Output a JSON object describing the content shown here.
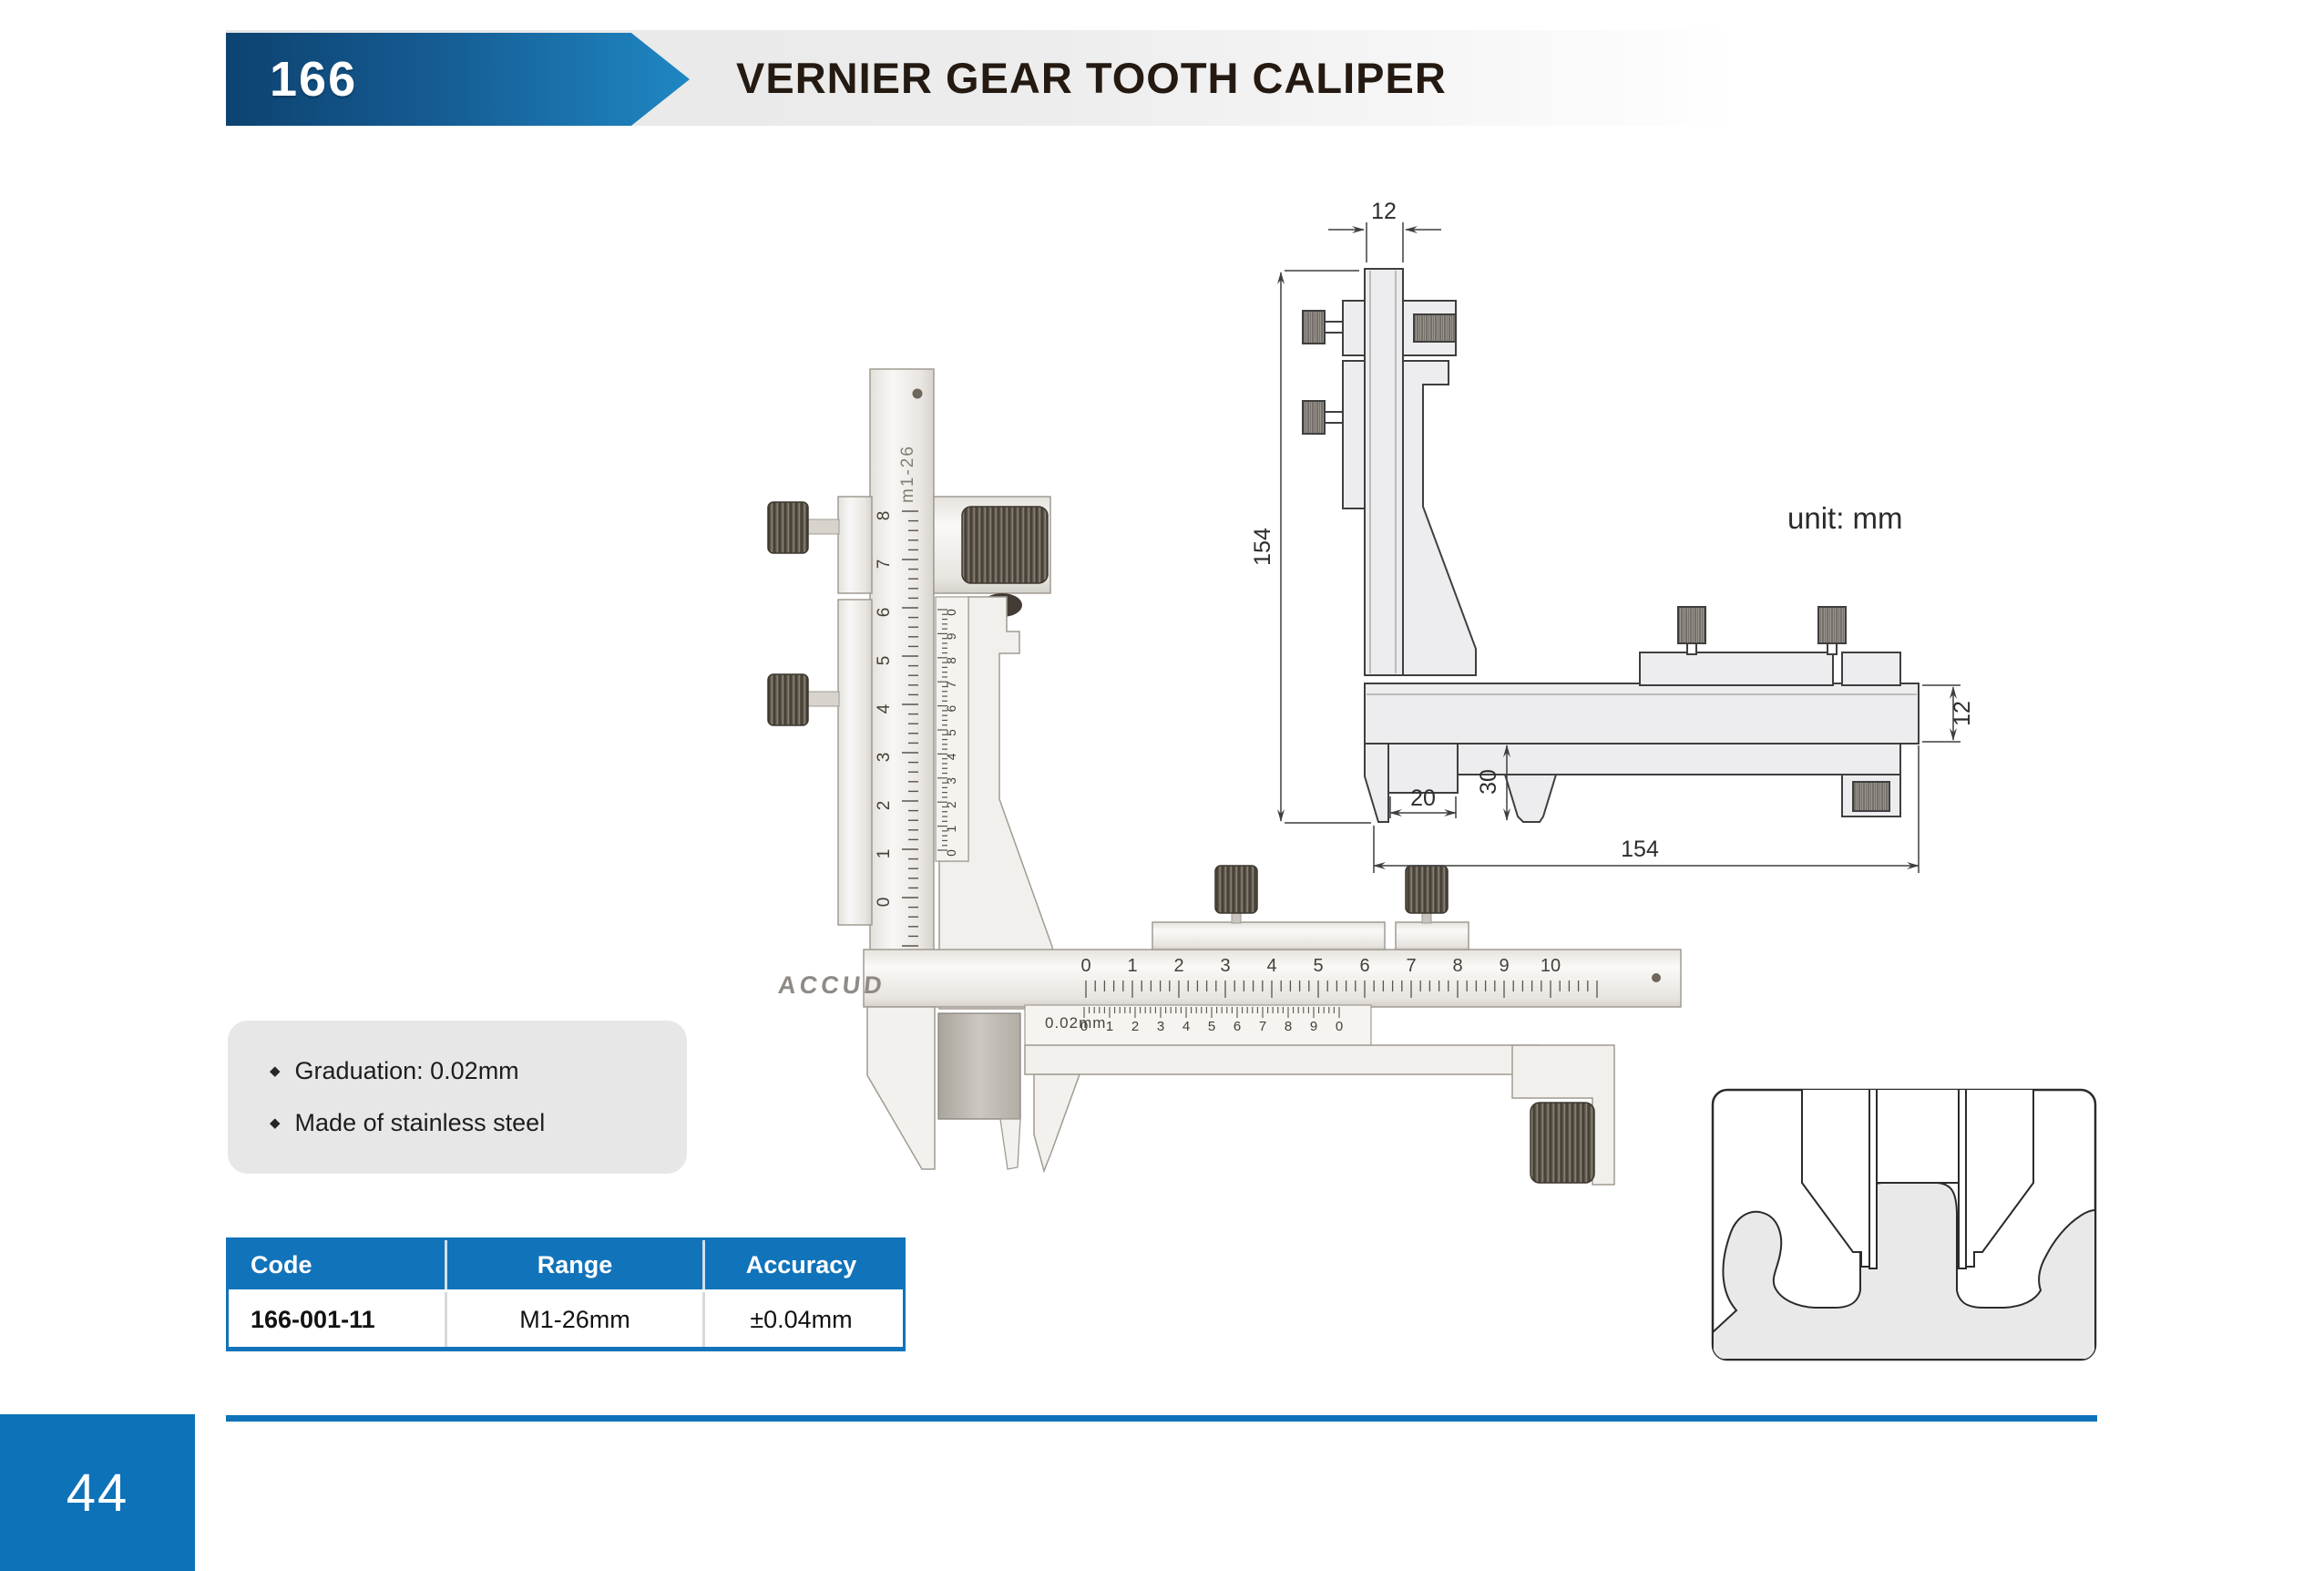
{
  "header": {
    "code": "166",
    "title": "VERNIER GEAR TOOTH CALIPER"
  },
  "drawing": {
    "unit_label": "unit: mm",
    "dimensions": {
      "top_width": "12",
      "total_height": "154",
      "beam_section": "12",
      "total_length": "154",
      "jaw_step_width": "20",
      "jaw_depth": "30"
    }
  },
  "caliper": {
    "brand": "ACCUD",
    "module_range_label": "m1-26",
    "vernier_resolution_label": "0.02mm",
    "vertical_main_numbers": [
      "8",
      "7",
      "6",
      "5",
      "4",
      "3",
      "2",
      "1",
      "0"
    ],
    "vertical_vernier_numbers": [
      "0",
      "9",
      "8",
      "7",
      "6",
      "5",
      "4",
      "3",
      "2",
      "1",
      "0"
    ],
    "horizontal_main_numbers": [
      "0",
      "1",
      "2",
      "3",
      "4",
      "5",
      "6",
      "7",
      "8",
      "9",
      "10"
    ],
    "horizontal_vernier_numbers": [
      "0",
      "1",
      "2",
      "3",
      "4",
      "5",
      "6",
      "7",
      "8",
      "9",
      "0"
    ]
  },
  "features": {
    "bullet": "◆",
    "items": [
      "Graduation: 0.02mm",
      "Made of stainless steel"
    ]
  },
  "table": {
    "headers": [
      "Code",
      "Range",
      "Accuracy"
    ],
    "rows": [
      {
        "code": "166-001-11",
        "range": "M1-26mm",
        "accuracy": "±0.04mm"
      }
    ]
  },
  "footer": {
    "page_number": "44"
  },
  "colors": {
    "brand_blue": "#0e72b8",
    "arrow_dark": "#0d4371",
    "arrow_light": "#1f87c3",
    "title_ink": "#241a12",
    "table_header_bg": "#1173ba"
  }
}
